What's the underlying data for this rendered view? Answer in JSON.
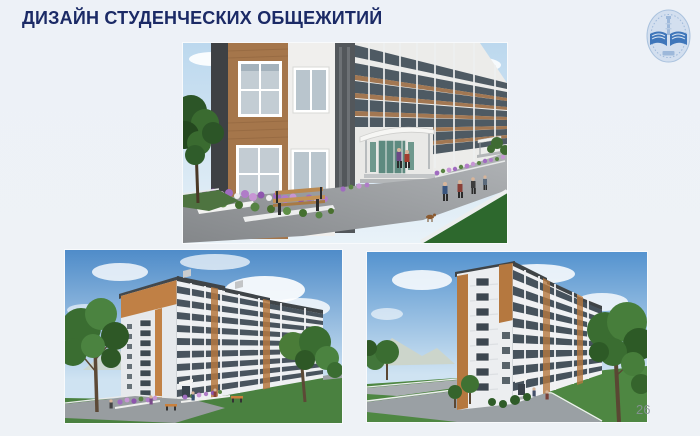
{
  "slide": {
    "title": "ДИЗАЙН СТУДЕНЧЕСКИХ ОБЩЕЖИТИЙ",
    "page_number": "26"
  },
  "logo": {
    "icon": "university-emblem-icon"
  },
  "images": {
    "top": "dormitory-street-entrance-render",
    "bottom_left": "dormitory-corner-view-render",
    "bottom_right": "dormitory-end-facade-render"
  },
  "palette": {
    "background": "#eef1f6",
    "title_color": "#1b2a66",
    "facade_brown": "#a5764b",
    "accent_orange": "#c08045",
    "sky_blue": "#4f8cc9",
    "lawn_green": "#4a8140",
    "asphalt_gray": "#96999d",
    "logo_blue": "#4a7fc0",
    "flower_purple": "#a06cc0"
  }
}
